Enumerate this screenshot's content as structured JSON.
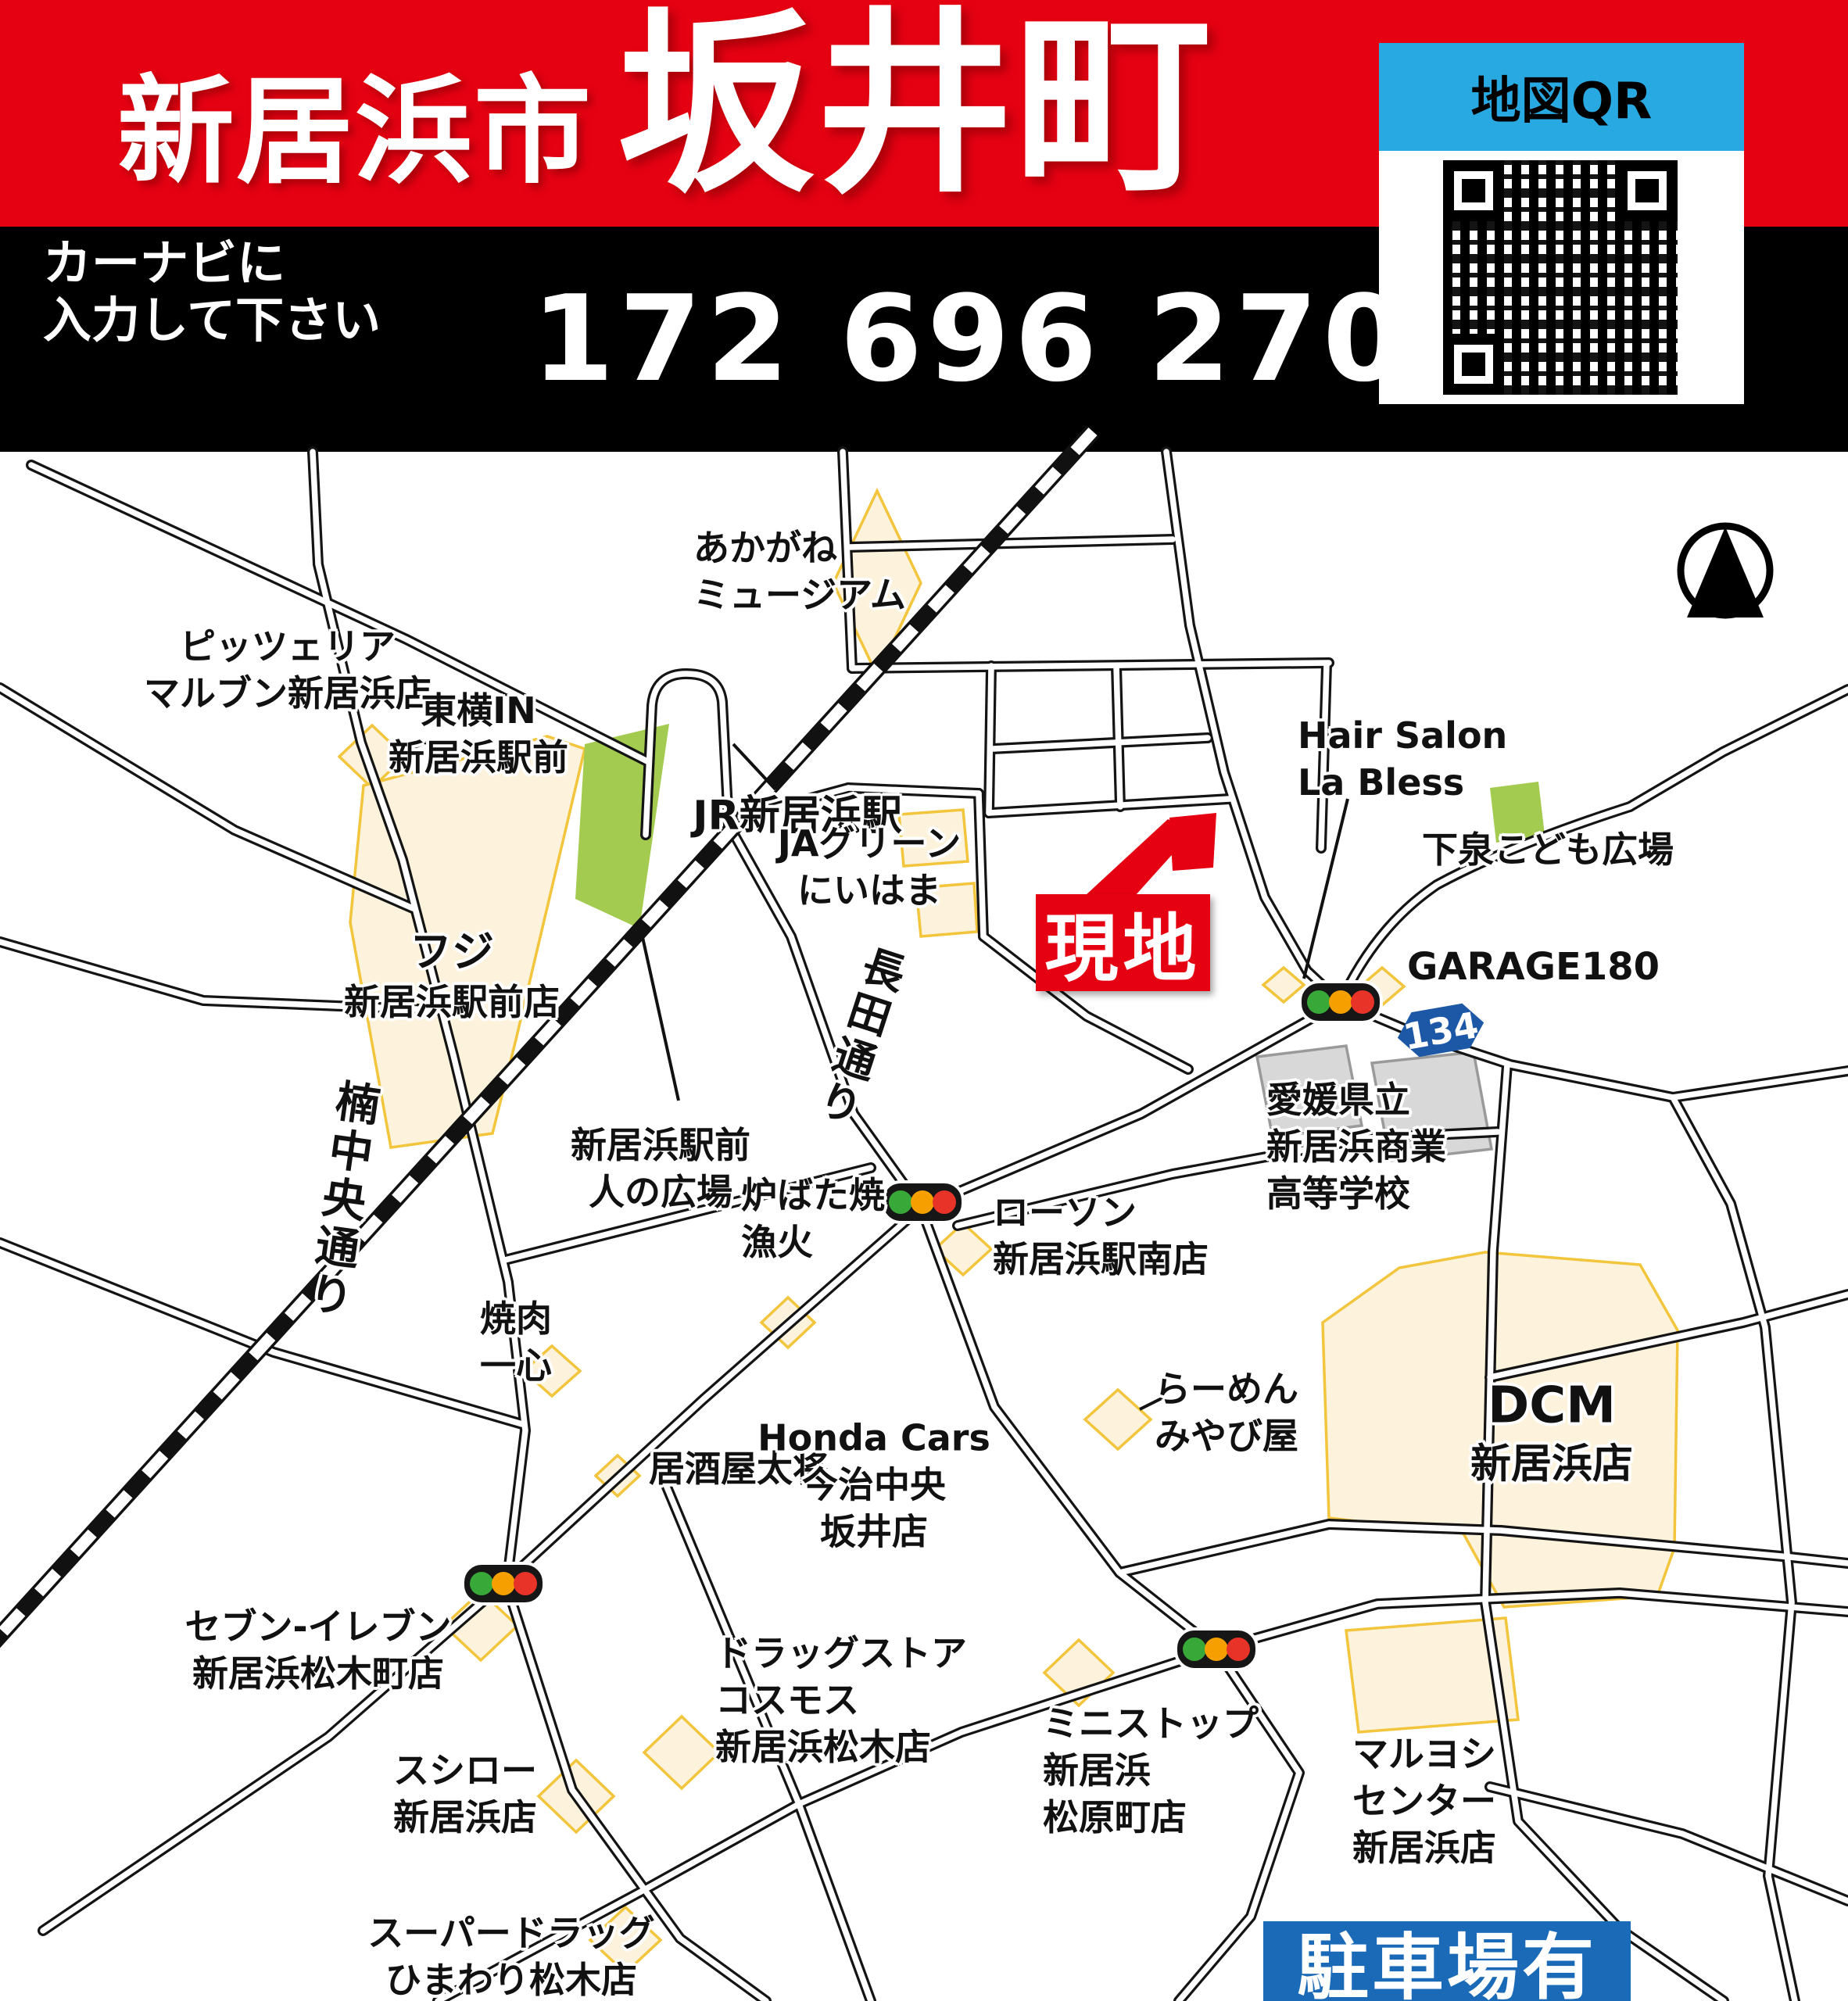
{
  "header": {
    "city": "新居浜市",
    "town": "坂井町"
  },
  "navi": {
    "line1": "カーナビに",
    "line2": "入力して下さい",
    "mapcode": "172 696 270"
  },
  "qr": {
    "label": "地図QR"
  },
  "markers": {
    "site": "現地",
    "parking": "駐車場有",
    "route": "134"
  },
  "road_names": {
    "kusu": "楠中央通り",
    "nagata": "長田通り"
  },
  "places": [
    {
      "id": "pizzeria-marubun",
      "lines": [
        "ピッツェリア",
        "マルブン新居浜店"
      ]
    },
    {
      "id": "toyoko-in",
      "lines": [
        "東横IN",
        "新居浜駅前"
      ]
    },
    {
      "id": "akagane-museum",
      "lines": [
        "あかがね",
        "ミュージアム"
      ]
    },
    {
      "id": "jr-niihama-sta",
      "lines": [
        "JR新居浜駅"
      ]
    },
    {
      "id": "fuji-ekimae",
      "lines": [
        "フジ",
        "新居浜駅前店"
      ]
    },
    {
      "id": "ja-green",
      "lines": [
        "JAグリーン",
        "にいはま"
      ]
    },
    {
      "id": "hito-no-hiroba",
      "lines": [
        "新居浜駅前",
        "人の広場"
      ]
    },
    {
      "id": "hair-salon",
      "lines": [
        "Hair Salon",
        "La Bless"
      ]
    },
    {
      "id": "shimoizumi-park",
      "lines": [
        "下泉こども広場"
      ]
    },
    {
      "id": "garage180",
      "lines": [
        "GARAGE180"
      ]
    },
    {
      "id": "school",
      "lines": [
        "愛媛県立",
        "新居浜商業",
        "高等学校"
      ]
    },
    {
      "id": "lawson",
      "lines": [
        "ローソン",
        "新居浜駅南店"
      ]
    },
    {
      "id": "robatayaki",
      "lines": [
        "炉ばた焼",
        "漁火"
      ]
    },
    {
      "id": "yakiniku-isshin",
      "lines": [
        "焼肉",
        "一心"
      ]
    },
    {
      "id": "izakaya-taisho",
      "lines": [
        "居酒屋太将"
      ]
    },
    {
      "id": "honda-cars",
      "lines": [
        "Honda Cars",
        "今治中央",
        "坂井店"
      ]
    },
    {
      "id": "ramen-miyabiya",
      "lines": [
        "らーめん",
        "みやび屋"
      ]
    },
    {
      "id": "dcm",
      "lines": [
        "DCM",
        "新居浜店"
      ]
    },
    {
      "id": "seven-eleven",
      "lines": [
        "セブン-イレブン",
        "新居浜松木町店"
      ]
    },
    {
      "id": "sushiro",
      "lines": [
        "スシロー",
        "新居浜店"
      ]
    },
    {
      "id": "cosmos",
      "lines": [
        "ドラッグストア",
        "コスモス",
        "新居浜松木店"
      ]
    },
    {
      "id": "himawari",
      "lines": [
        "スーパードラッグ",
        "ひまわり松木店"
      ]
    },
    {
      "id": "ministop",
      "lines": [
        "ミニストップ",
        "新居浜",
        "松原町店"
      ]
    },
    {
      "id": "maruyoshi",
      "lines": [
        "マルヨシ",
        "センター",
        "新居浜店"
      ]
    }
  ]
}
